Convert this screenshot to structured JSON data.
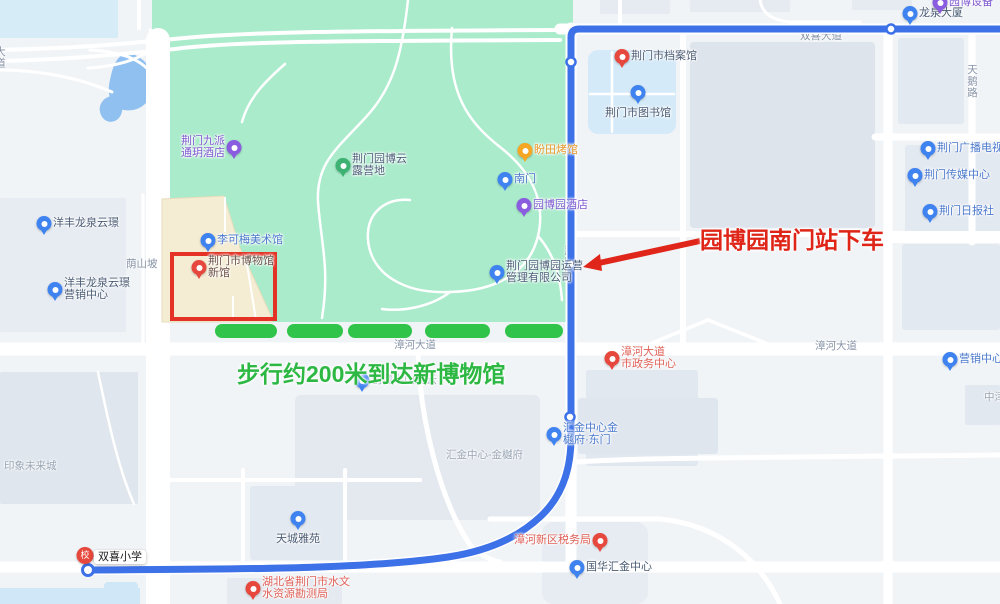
{
  "annotations": {
    "alight_note": {
      "text": "园博园南门站下车",
      "x": 700,
      "y": 221,
      "color": "#df2518",
      "size": 23
    },
    "walk_note": {
      "text": "步行约200米到达新博物馆",
      "x": 237,
      "y": 355,
      "color": "#2db843",
      "size": 23
    },
    "museum_highlight_box": {
      "x": 172,
      "y": 254,
      "w": 103,
      "h": 65,
      "color": "#e43326"
    },
    "walk_dashes": {
      "color": "#30c44a",
      "y": 324,
      "h": 14,
      "bars": [
        {
          "x": 215,
          "w": 62
        },
        {
          "x": 287,
          "w": 56
        },
        {
          "x": 348,
          "w": 64
        },
        {
          "x": 425,
          "w": 65
        },
        {
          "x": 505,
          "w": 58
        }
      ]
    }
  },
  "colors": {
    "route": "#3d71e8",
    "park": "#a9ebcb",
    "water": "#8fc0f0",
    "museum_area": "#f4edd3",
    "background": "#f1f4f7",
    "annotation_red": "#df2518",
    "annotation_green": "#2db843"
  },
  "pois": [
    {
      "name": "poi-longquan-building",
      "type": "blue",
      "x": 910,
      "y": 25,
      "side": "right",
      "color": "#4a5b74",
      "lines": [
        "龙泉大厦"
      ]
    },
    {
      "name": "poi-yuanbo-equipment",
      "type": "purple",
      "x": 940,
      "y": 14,
      "side": "right",
      "color": "#7d57d0",
      "lines": [
        "园博设备"
      ]
    },
    {
      "name": "poi-jingmen-archives",
      "type": "red",
      "x": 622,
      "y": 68,
      "side": "right",
      "color": "#4f5d75",
      "lines": [
        "荆门市档案馆"
      ]
    },
    {
      "name": "poi-jingmen-library",
      "type": "blue",
      "x": 638,
      "y": 104,
      "side": "below",
      "color": "#4a5b74",
      "lines": [
        "荆门市图书馆"
      ]
    },
    {
      "name": "poi-jingmen-broadcast-tv",
      "type": "blue",
      "x": 928,
      "y": 160,
      "side": "right",
      "color": "#4a79cc",
      "lines": [
        "荆门广播电视台"
      ]
    },
    {
      "name": "poi-jingmen-media-center",
      "type": "blue",
      "x": 915,
      "y": 187,
      "side": "right",
      "color": "#4a79cc",
      "lines": [
        "荆门传媒中心"
      ]
    },
    {
      "name": "poi-jingmen-daily-news",
      "type": "blue",
      "x": 930,
      "y": 223,
      "side": "right",
      "color": "#4a79cc",
      "lines": [
        "荆门日报社"
      ]
    },
    {
      "name": "poi-jiupai-hotel",
      "type": "purple",
      "x": 234,
      "y": 159,
      "side": "left",
      "color": "#7d57d0",
      "lines": [
        "荆门九派",
        "通玥酒店"
      ]
    },
    {
      "name": "poi-yuanbo-camp",
      "type": "green",
      "x": 343,
      "y": 177,
      "side": "right",
      "color": "#4c5f79",
      "lines": [
        "荆门园博云",
        "露营地"
      ]
    },
    {
      "name": "poi-pantian-restaurant",
      "type": "orange",
      "x": 525,
      "y": 162,
      "side": "right",
      "color": "#e89a2e",
      "lines": [
        "盼田烤馆"
      ]
    },
    {
      "name": "poi-south-gate",
      "type": "blue",
      "x": 505,
      "y": 191,
      "side": "right",
      "color": "#4a79cc",
      "lines": [
        "南门"
      ]
    },
    {
      "name": "poi-yuanboyuan-hotel",
      "type": "purple",
      "x": 524,
      "y": 217,
      "side": "right",
      "color": "#7d57d0",
      "lines": [
        "园博园酒店"
      ]
    },
    {
      "name": "poi-likemei-gallery",
      "type": "blue",
      "x": 208,
      "y": 252,
      "side": "right",
      "color": "#4a79cc",
      "lines": [
        "李可梅美术馆"
      ]
    },
    {
      "name": "poi-jingmen-museum-new",
      "type": "red",
      "x": 199,
      "y": 279,
      "side": "right",
      "color": "#6b4f45",
      "lines": [
        "荆门市博物馆",
        "新馆"
      ]
    },
    {
      "name": "poi-yangfeng-longquan",
      "type": "blue",
      "x": 44,
      "y": 235,
      "side": "right",
      "color": "#4a5b74",
      "lines": [
        "洋丰龙泉云璟"
      ]
    },
    {
      "name": "poi-yangfeng-marketing",
      "type": "blue",
      "x": 55,
      "y": 301,
      "side": "right",
      "color": "#4a5b74",
      "lines": [
        "洋丰龙泉云璟",
        "营销中心"
      ]
    },
    {
      "name": "poi-yuanbo-operations",
      "type": "blue",
      "x": 497,
      "y": 284,
      "side": "right",
      "color": "#4c5f79",
      "lines": [
        "荆门园博园运营",
        "管理有限公司"
      ]
    },
    {
      "name": "poi-chuangwan-banshan",
      "type": "blue",
      "x": 362,
      "y": 392,
      "side": "right",
      "color": "#8795ab",
      "lines": [
        "创湾半山观云"
      ]
    },
    {
      "name": "poi-zhanghe-gov-center",
      "type": "red",
      "x": 612,
      "y": 370,
      "side": "right",
      "color": "#df6158",
      "lines": [
        "漳河大道",
        "市政务中心"
      ]
    },
    {
      "name": "poi-marketing-center",
      "type": "blue",
      "x": 950,
      "y": 371,
      "side": "right",
      "color": "#4a79cc",
      "lines": [
        "营销中心"
      ]
    },
    {
      "name": "poi-huijin-east-gate",
      "type": "blue",
      "x": 554,
      "y": 446,
      "side": "right",
      "color": "#4a79cc",
      "lines": [
        "汇金中心金",
        "樾府·东门"
      ]
    },
    {
      "name": "poi-tiancheng-yayuan",
      "type": "blue",
      "x": 298,
      "y": 530,
      "side": "below",
      "color": "#4a5b74",
      "lines": [
        "天城雅苑"
      ]
    },
    {
      "name": "poi-hydrology-bureau",
      "type": "red",
      "x": 253,
      "y": 600,
      "side": "right",
      "color": "#df6158",
      "lines": [
        "湖北省荆门市水文",
        "水资源勘测局"
      ]
    },
    {
      "name": "poi-tax-bureau",
      "type": "red",
      "x": 600,
      "y": 552,
      "side": "left",
      "color": "#df6158",
      "lines": [
        "漳河新区税务局"
      ]
    },
    {
      "name": "poi-guohua-huijin",
      "type": "blue",
      "x": 577,
      "y": 579,
      "side": "right",
      "color": "#4a5b74",
      "lines": [
        "国华汇金中心"
      ]
    },
    {
      "name": "poi-shuangxi-school",
      "type": "school",
      "x": 85,
      "y": 568,
      "side": "right",
      "color": "#222222",
      "boxed": true,
      "lines": [
        "双喜小学"
      ]
    }
  ],
  "road_labels": [
    {
      "name": "road-shuangxi-avenue",
      "text": "双喜大道",
      "x": 800,
      "y": 31
    },
    {
      "name": "road-tiane-road",
      "text": "天鹅路",
      "x": 966,
      "y": 64,
      "vertical": true
    },
    {
      "name": "road-zhanghe-avenue-west",
      "text": "漳河大道",
      "x": 394,
      "y": 340
    },
    {
      "name": "road-zhanghe-avenue-east",
      "text": "漳河大道",
      "x": 815,
      "y": 341
    },
    {
      "name": "road-yinshanpo",
      "text": "荫山坡",
      "x": 126,
      "y": 259
    },
    {
      "name": "road-huimin-road",
      "text": "惠民路",
      "x": 563,
      "y": 245,
      "vertical": true
    },
    {
      "name": "area-huijin-jinyuefu",
      "text": "汇金中心-金樾府",
      "x": 446,
      "y": 450,
      "color": "#9aa5b5"
    },
    {
      "name": "area-yinxiang-future-city",
      "text": "印象未来城",
      "x": 4,
      "y": 461,
      "color": "#9aa5b5"
    },
    {
      "name": "area-zhongjin-partial",
      "text": "中津",
      "x": 984,
      "y": 392,
      "color": "#9aa5b5"
    },
    {
      "name": "road-left-edge-partial",
      "text": "大道",
      "x": -6,
      "y": 46,
      "vertical": true
    }
  ]
}
